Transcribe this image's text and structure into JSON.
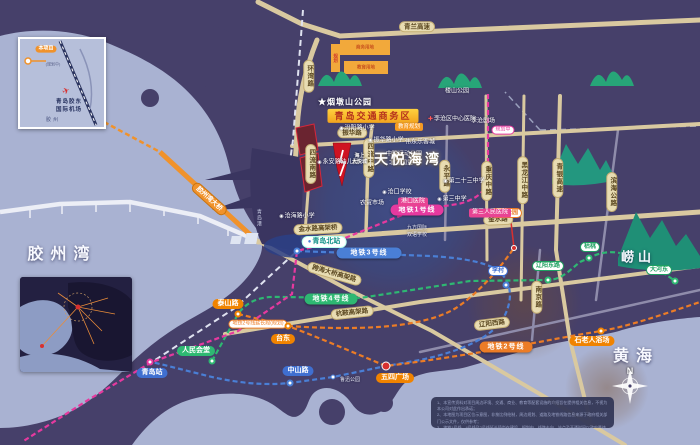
{
  "colors": {
    "land": "#46406a",
    "water": "#a9b2d2",
    "road_tan": "#d9c9a0",
    "line1": "#e6399f",
    "line2": "#ec7c26",
    "line3": "#4a7fd6",
    "line4": "#2eb872",
    "highlight_circle": "#3e508e",
    "accent_yellow": "#f2a41e",
    "accent_red": "#cf1322"
  },
  "project_logo": {
    "brand_top": "海上",
    "brand_bottom": "大悦城",
    "name": "天悦海湾"
  },
  "compass": {
    "n_label": "N"
  },
  "map": {
    "labels": [
      {
        "n": "jiaozhou-bay-label",
        "t": "胶州湾",
        "x": 62,
        "y": 255,
        "k": "sea"
      },
      {
        "n": "yellow-sea-label",
        "t": "黄海",
        "x": 636,
        "y": 357,
        "k": "sea"
      },
      {
        "n": "laoshan-label",
        "t": "崂山",
        "x": 638,
        "y": 258,
        "k": "sea sea-sm"
      },
      {
        "n": "road-qinglan-expwy",
        "t": "青兰高速",
        "x": 417,
        "y": 27,
        "k": "roadh"
      },
      {
        "n": "road-huanwan",
        "t": "环湾路",
        "x": 309,
        "y": 76,
        "k": "roadv"
      },
      {
        "n": "road-siliu-south",
        "t": "四流南路",
        "x": 311,
        "y": 164,
        "k": "roadv"
      },
      {
        "n": "road-siliu-middle",
        "t": "四流中路",
        "x": 369,
        "y": 158,
        "k": "roadv"
      },
      {
        "n": "road-zhenhua",
        "t": "振华路",
        "x": 352,
        "y": 133,
        "k": "roadh"
      },
      {
        "n": "road-jinshui-viaduct",
        "t": "金水路高架桥",
        "x": 318,
        "y": 229,
        "k": "roadh",
        "r": -3
      },
      {
        "n": "road-jinshui",
        "t": "金水路",
        "x": 498,
        "y": 220,
        "k": "roadh",
        "r": -2
      },
      {
        "n": "road-cross-sea-viaduct",
        "t": "跨海大桥高架路",
        "x": 334,
        "y": 274,
        "k": "roadh",
        "r": 16
      },
      {
        "n": "road-hangan-viaduct",
        "t": "杭鞍高架路",
        "x": 352,
        "y": 313,
        "k": "roadh",
        "r": -6
      },
      {
        "n": "road-jiaozhou-bay-bridge",
        "t": "胶州湾大桥",
        "x": 209,
        "y": 199,
        "k": "roado",
        "r": 42
      },
      {
        "n": "road-chongqing-middle",
        "t": "重庆中路",
        "x": 487,
        "y": 181,
        "k": "roadv"
      },
      {
        "n": "road-heilongjiang-middle",
        "t": "黑龙江中路",
        "x": 523,
        "y": 180,
        "k": "roadv"
      },
      {
        "n": "road-qingyin-expwy",
        "t": "青银高速",
        "x": 558,
        "y": 178,
        "k": "roadv"
      },
      {
        "n": "road-binhai-highway",
        "t": "滨海公路",
        "x": 612,
        "y": 192,
        "k": "roadv"
      },
      {
        "n": "road-yongping",
        "t": "永平路",
        "x": 445,
        "y": 176,
        "k": "roadv"
      },
      {
        "n": "road-liaoyang-west",
        "t": "辽阳西路",
        "x": 492,
        "y": 324,
        "k": "roadh",
        "r": -7
      },
      {
        "n": "road-nanjing",
        "t": "南京路",
        "x": 537,
        "y": 297,
        "k": "roadv"
      },
      {
        "n": "metro-line1-label",
        "t": "地铁1号线",
        "x": 417,
        "y": 210,
        "k": "m1"
      },
      {
        "n": "metro-line3-label",
        "t": "地铁3号线",
        "x": 369,
        "y": 253,
        "k": "m3"
      },
      {
        "n": "metro-line4-label",
        "t": "地铁4号线",
        "x": 331,
        "y": 299,
        "k": "m4"
      },
      {
        "n": "metro-line2-label",
        "t": "地铁2号线",
        "x": 506,
        "y": 347,
        "k": "m2"
      },
      {
        "n": "metro-line2-ext-label",
        "t": "地铁2号线延长段(规划)",
        "x": 258,
        "y": 324,
        "k": "m2x"
      },
      {
        "n": "line1-planned-label",
        "t": "规划中",
        "x": 503,
        "y": 130,
        "k": "plan"
      },
      {
        "n": "station-qingdao-north",
        "t": "青岛北站",
        "x": 324,
        "y": 242,
        "k": "stwhite",
        "icon": "●"
      },
      {
        "n": "station-qingdao",
        "t": "青岛站",
        "x": 152,
        "y": 373,
        "k": "stblue"
      },
      {
        "n": "station-zhongshan-road",
        "t": "中山路",
        "x": 298,
        "y": 371,
        "k": "stblue"
      },
      {
        "n": "station-renmin-huitang",
        "t": "人民会堂",
        "x": 196,
        "y": 351,
        "k": "stgreen"
      },
      {
        "n": "station-taishan-road",
        "t": "泰山路",
        "x": 228,
        "y": 304,
        "k": "storange"
      },
      {
        "n": "station-taidong",
        "t": "台东",
        "x": 283,
        "y": 339,
        "k": "storange"
      },
      {
        "n": "station-wusi-square",
        "t": "五四广场",
        "x": 395,
        "y": 378,
        "k": "storange"
      },
      {
        "n": "station-shilaoren-beach",
        "t": "石老人浴场",
        "x": 592,
        "y": 341,
        "k": "storange"
      },
      {
        "n": "station-licun",
        "t": "李村",
        "x": 498,
        "y": 271,
        "k": "stblueo"
      },
      {
        "n": "station-licun-park",
        "t": "李村公园",
        "x": 506,
        "y": 213,
        "k": "storangeo"
      },
      {
        "n": "station-liaoyang-east",
        "t": "辽阳东路",
        "x": 548,
        "y": 266,
        "k": "stgreeno"
      },
      {
        "n": "station-kutao",
        "t": "枯桃",
        "x": 590,
        "y": 247,
        "k": "stgreeno"
      },
      {
        "n": "station-dahedong",
        "t": "大河东",
        "x": 659,
        "y": 270,
        "k": "stgreeno"
      },
      {
        "n": "luxun-park-label",
        "t": "鲁迅公园",
        "x": 350,
        "y": 381,
        "k": "txtxs"
      },
      {
        "n": "yandunshan-park-label",
        "t": "★烟墩山公园",
        "x": 345,
        "y": 102,
        "k": "txtlg"
      },
      {
        "n": "qingdao-traffic-business-district",
        "t": "青岛交通商务区",
        "x": 373,
        "y": 116,
        "k": "area"
      },
      {
        "n": "fenyang-road-primary-school",
        "t": "汾阳路小学",
        "x": 357,
        "y": 129,
        "k": "school",
        "icon": "◉"
      },
      {
        "n": "education-planning-label",
        "t": "教育规划",
        "x": 409,
        "y": 127,
        "k": "zoneedu"
      },
      {
        "n": "licang-central-hospital",
        "t": "李沧区中心医院",
        "x": 452,
        "y": 120,
        "k": "hospw",
        "icon": "✚"
      },
      {
        "n": "licang-theater",
        "t": "李沧剧场",
        "x": 483,
        "y": 122,
        "k": "txt"
      },
      {
        "n": "loushan-park-label",
        "t": "楼山公园",
        "x": 457,
        "y": 92,
        "k": "txt"
      },
      {
        "n": "zhenhua-road-primary-school",
        "t": "振华路小学",
        "x": 386,
        "y": 141,
        "k": "school",
        "icon": "◉"
      },
      {
        "n": "weidong-lekecheng-mall",
        "t": "伟东乐客城",
        "x": 420,
        "y": 143,
        "k": "txt"
      },
      {
        "n": "yongan-road-kindergarten",
        "t": "永安路幼儿园",
        "x": 338,
        "y": 163,
        "k": "school",
        "icon": "◉"
      },
      {
        "n": "zhonglian-sports-park",
        "t": "中联运动公园",
        "x": 404,
        "y": 155,
        "k": "txt"
      },
      {
        "n": "beifang-guomao",
        "t": "北方国贸",
        "x": 401,
        "y": 164,
        "k": "txt"
      },
      {
        "n": "cangkou-school",
        "t": "沧口学校",
        "x": 397,
        "y": 193,
        "k": "school",
        "icon": "◉"
      },
      {
        "n": "farmers-market",
        "t": "农贸市场",
        "x": 372,
        "y": 204,
        "k": "txt"
      },
      {
        "n": "gangkou-hospital",
        "t": "港口医院",
        "x": 413,
        "y": 202,
        "k": "hosp"
      },
      {
        "n": "no23-middle-school",
        "t": "第二十三中学",
        "x": 464,
        "y": 182,
        "k": "school",
        "icon": "◉"
      },
      {
        "n": "no3-middle-school",
        "t": "第三中学",
        "x": 452,
        "y": 200,
        "k": "school",
        "icon": "◉"
      },
      {
        "n": "no3-peoples-hospital",
        "t": "第三人民医院",
        "x": 490,
        "y": 213,
        "k": "hosp"
      },
      {
        "n": "jiufang-intl-line1",
        "t": "九方国际",
        "x": 417,
        "y": 229,
        "k": "txtxs"
      },
      {
        "n": "jiufang-intl-line2",
        "t": "双语学校",
        "x": 417,
        "y": 236,
        "k": "txtxs"
      },
      {
        "n": "qingdao-port-label",
        "t": "青岛港",
        "x": 258,
        "y": 218,
        "k": "portv"
      },
      {
        "n": "canghai-road-primary-school",
        "t": "沧海路小学",
        "x": 297,
        "y": 217,
        "k": "school",
        "icon": "◉"
      },
      {
        "n": "zone-business-label",
        "t": "商务用地",
        "x": 365,
        "y": 47,
        "k": "zonetx"
      },
      {
        "n": "zone-education-label",
        "t": "教育用地",
        "x": 366,
        "y": 67,
        "k": "zonetx"
      },
      {
        "n": "zone-planning-label",
        "t": "规划",
        "x": 336,
        "y": 58,
        "k": "zonetxv"
      }
    ],
    "points": [
      {
        "n": "station-icon-qingdao-north",
        "x": 297,
        "y": 251,
        "k": "pcb"
      },
      {
        "n": "station-icon-qingdao",
        "x": 150,
        "y": 362,
        "k": "pcp"
      },
      {
        "n": "station-icon-zhongshan-road",
        "x": 290,
        "y": 383,
        "k": "pcb"
      },
      {
        "n": "station-icon-renmin-huitang",
        "x": 212,
        "y": 361,
        "k": "pcg"
      },
      {
        "n": "station-icon-taishan-road",
        "x": 238,
        "y": 314,
        "k": "pco"
      },
      {
        "n": "station-icon-taidong",
        "x": 288,
        "y": 326,
        "k": "pco"
      },
      {
        "n": "station-icon-wusi-square",
        "x": 386,
        "y": 366,
        "k": "pcr"
      },
      {
        "n": "station-icon-shilaoren",
        "x": 601,
        "y": 331,
        "k": "pco"
      },
      {
        "n": "station-icon-licun",
        "x": 506,
        "y": 285,
        "k": "pcb"
      },
      {
        "n": "station-icon-licun-park",
        "x": 514,
        "y": 248,
        "k": "pcr2"
      },
      {
        "n": "station-icon-liaoyang-east",
        "x": 548,
        "y": 280,
        "k": "pcg"
      },
      {
        "n": "station-icon-kutao",
        "x": 589,
        "y": 258,
        "k": "pcg"
      },
      {
        "n": "station-icon-dahedong",
        "x": 675,
        "y": 281,
        "k": "pcg"
      },
      {
        "n": "station-icon-luxun-park",
        "x": 333,
        "y": 377,
        "k": "pcb pc-sm"
      }
    ]
  },
  "inset_airport": {
    "labels": [
      {
        "n": "inset-project-pill",
        "t": "本项目",
        "x": 26,
        "y": 10,
        "k": "iapill"
      },
      {
        "n": "inset-planned-note",
        "t": "(规划中)",
        "x": 33,
        "y": 26,
        "k": "iatxt"
      },
      {
        "n": "inset-plane-icon",
        "t": "✈",
        "x": 46,
        "y": 52,
        "k": "iaplane"
      },
      {
        "n": "inset-airport-name-1",
        "t": "青岛胶东",
        "x": 49,
        "y": 63,
        "k": "ianame"
      },
      {
        "n": "inset-airport-name-2",
        "t": "国际机场",
        "x": 49,
        "y": 71,
        "k": "ianame"
      },
      {
        "n": "inset-jiaozhou-label",
        "t": "胶州",
        "x": 33,
        "y": 82,
        "k": "iacity"
      }
    ]
  },
  "inset_region": {
    "labels": [
      {
        "n": "region-title",
        "t": "大悦城·天悦海湾",
        "x": 74,
        "y": 10,
        "k": "i2title"
      },
      {
        "n": "region-liuting-airport",
        "t": "流亭机场",
        "x": 38,
        "y": 17,
        "k": "i2oval"
      },
      {
        "n": "region-chengyang",
        "t": "城阳区",
        "x": 90,
        "y": 22,
        "k": "i2oval"
      },
      {
        "n": "region-laoshan",
        "t": "崂山区",
        "x": 97,
        "y": 38,
        "k": "i2oval"
      },
      {
        "n": "region-shibei",
        "t": "市北区",
        "x": 83,
        "y": 55,
        "k": "i2oval"
      },
      {
        "n": "region-shinan",
        "t": "市南区",
        "x": 74,
        "y": 69,
        "k": "i2oval"
      },
      {
        "n": "region-huangdao",
        "t": "黄岛",
        "x": 22,
        "y": 73,
        "k": "i2tx"
      },
      {
        "n": "region-jiaozhou-bay",
        "t": "胶州湾",
        "x": 36,
        "y": 45,
        "k": "i2sea"
      }
    ]
  },
  "disclaimer": {
    "lines": [
      "1、本宣传资料对项目周边环境、交通、商业、教育等配套设施的介绍旨在提供相关信息，不视为本公司对此作出承诺；",
      "2、本地图为项目区位示意图，非按比例绘制，周边规划、道路及地铁线路信息来源于政府相关部门公示文件，仅供参考；",
      "3、地铁1号线、4号线及2号线延长段尚在建设、规划中，线路走向、站点及开通时间以政府最终公布为准；",
      "4、本资料制作时间为2021年，敬请留意最新资料。"
    ]
  }
}
